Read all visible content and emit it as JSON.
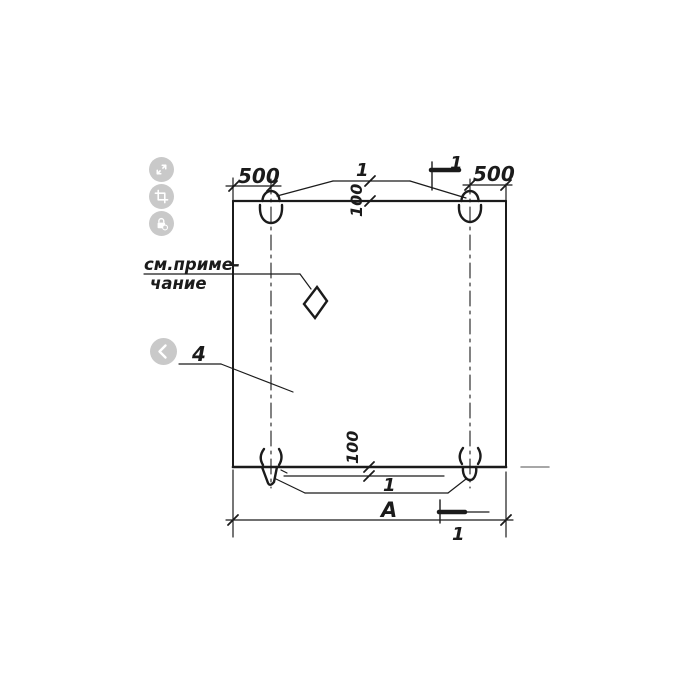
{
  "viewer": {
    "icons": {
      "expand": "expand-icon",
      "crop": "crop-icon",
      "lock": "lock-icon",
      "previous": "chevron-left-icon"
    }
  },
  "drawing": {
    "dimensions": {
      "top_left_edge_to_loop": "500",
      "top_right_edge_to_loop": "500",
      "top_loop_offset": "100",
      "bottom_loop_offset": "100",
      "overall_length": "А"
    },
    "callouts": {
      "top_loops_item": "1",
      "bottom_loops_item": "1",
      "panel_item": "4"
    },
    "section_marks": {
      "top_label": "1",
      "bottom_label": "1"
    },
    "note": {
      "line1": "см.приме-",
      "line2": "чание"
    }
  }
}
